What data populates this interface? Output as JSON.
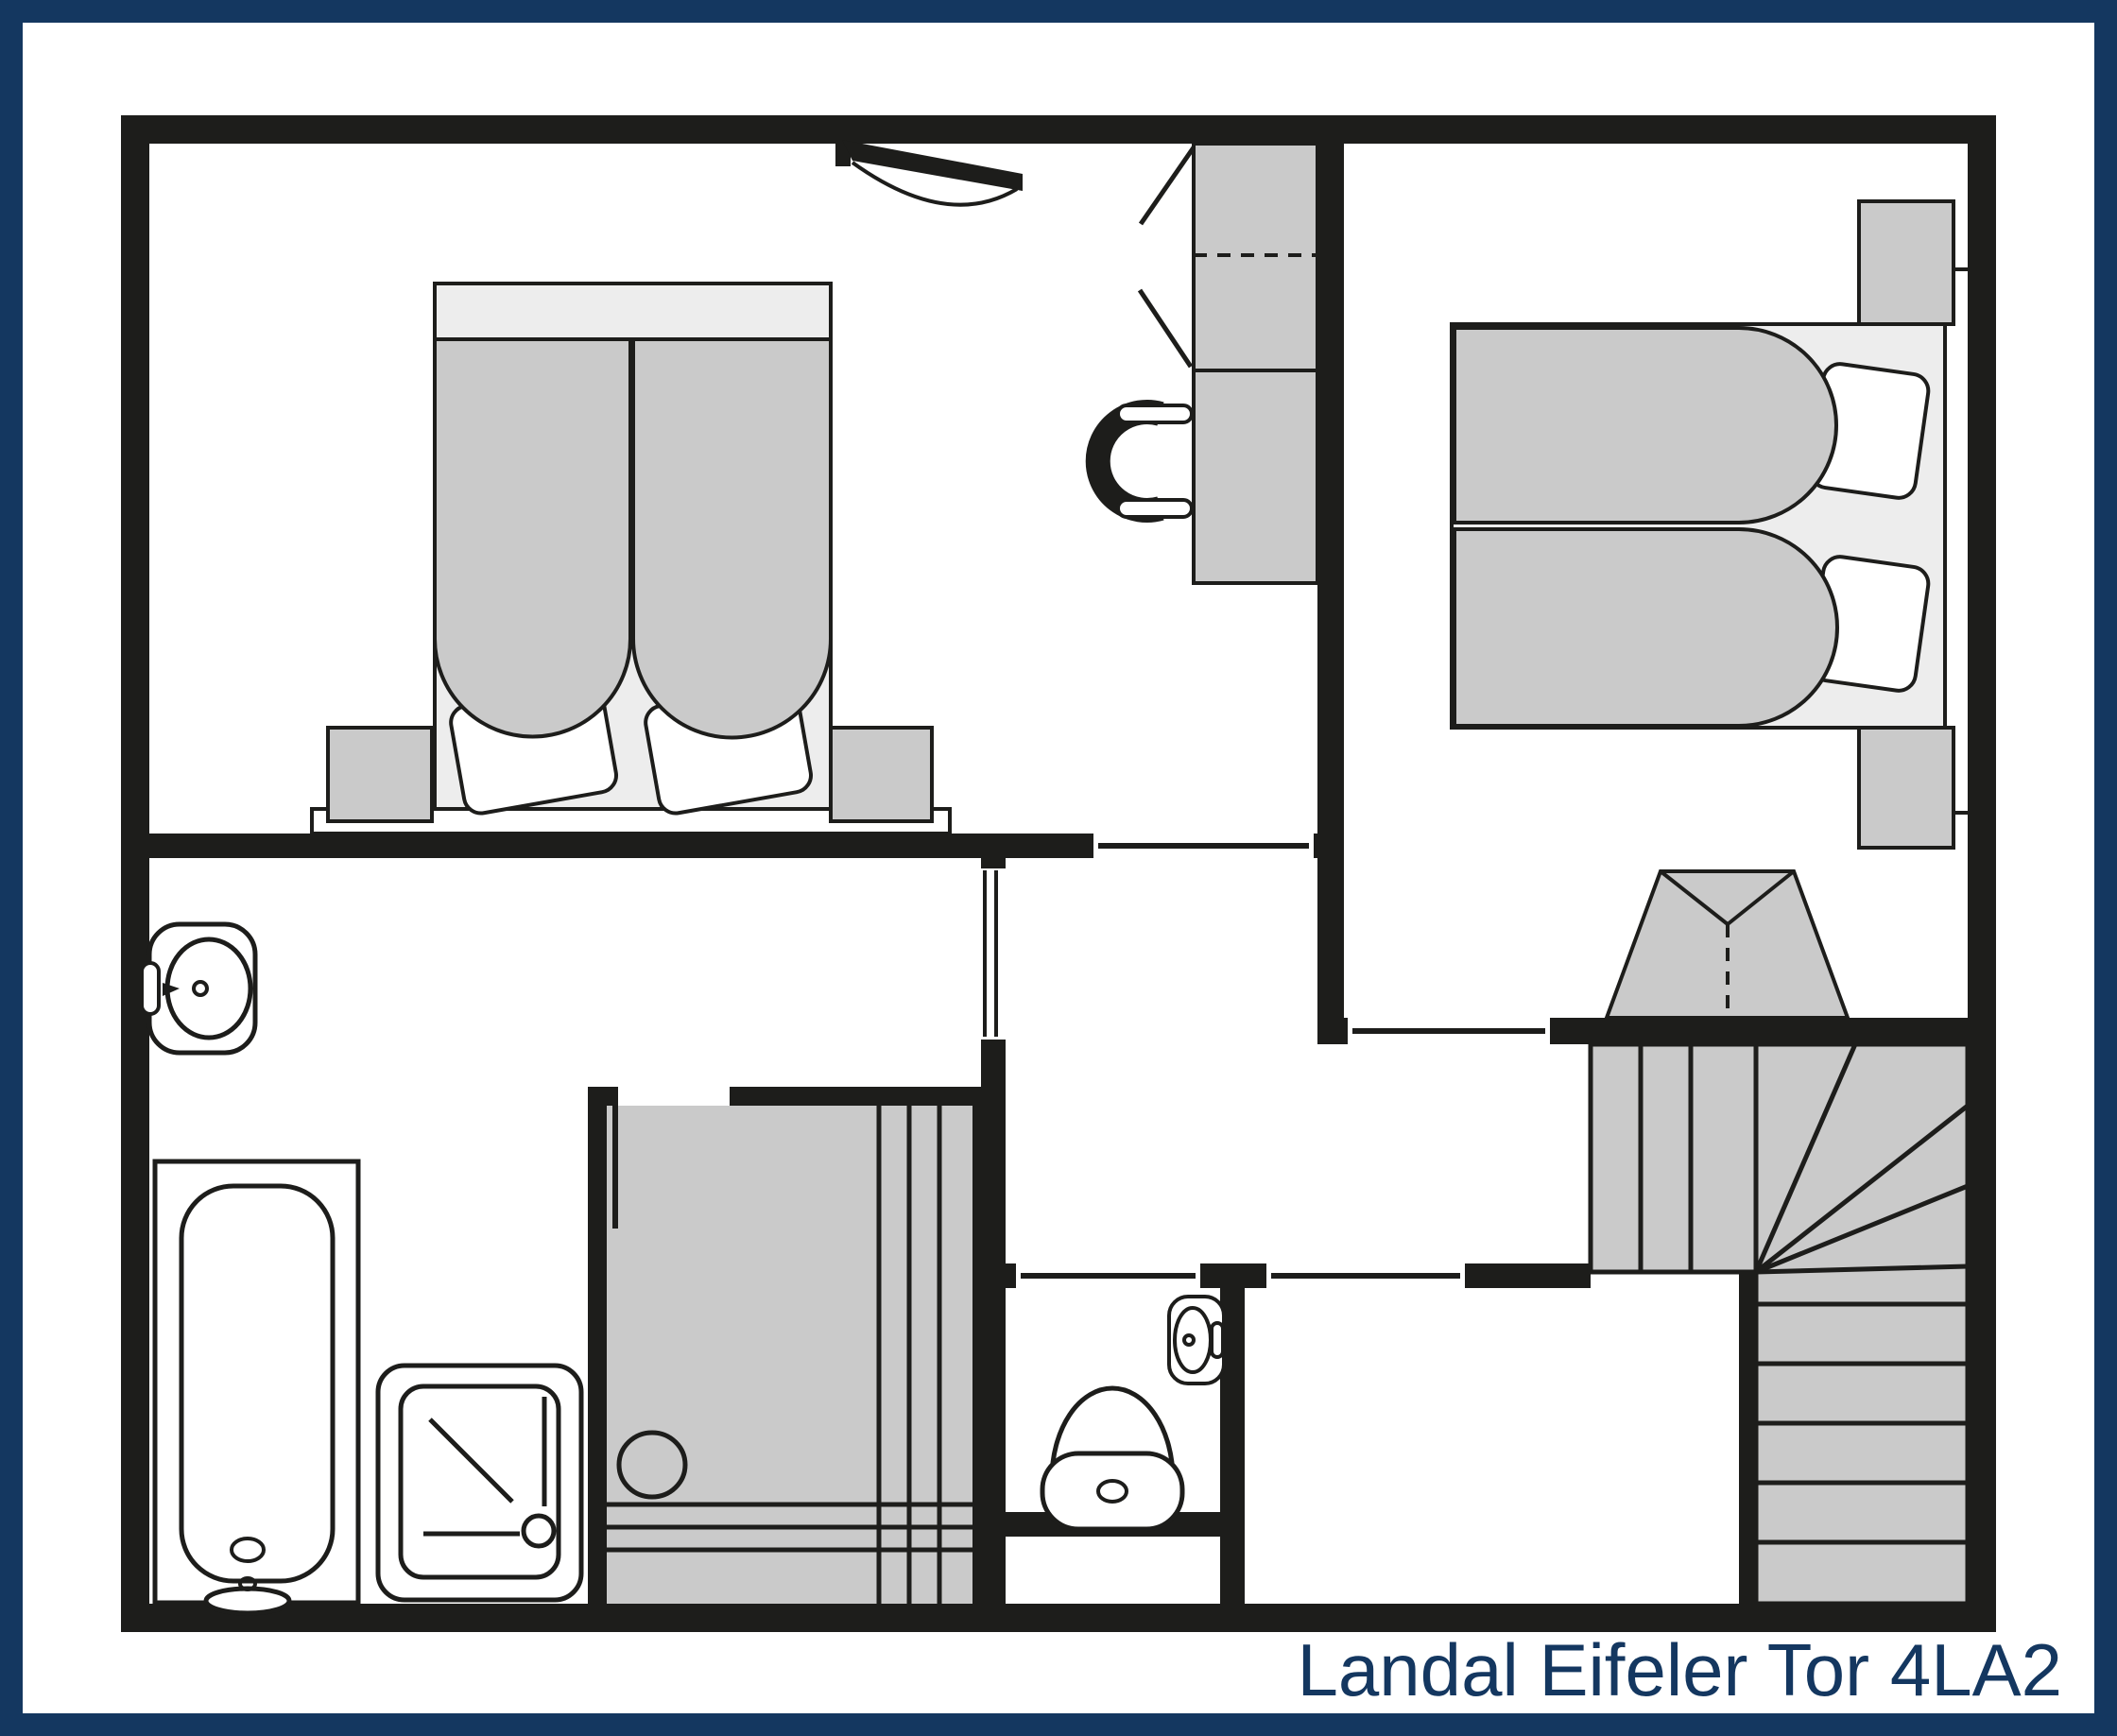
{
  "title": "Landal Eifeler Tor 4LA2",
  "colors": {
    "frame": "#143760",
    "wall": "#1d1d1b",
    "furniture_gray": "#cacaca",
    "bed_base_gray": "#ededed",
    "background": "#ffffff",
    "title_text": "#143760"
  },
  "icons": [
    "roof-window-icon",
    "double-bed-icon",
    "duvet-icon",
    "pillow-icon",
    "nightstand-icon",
    "wardrobe-icon",
    "desk-icon",
    "office-chair-icon",
    "washbasin-icon",
    "bathtub-icon",
    "shower-tray-icon",
    "sauna-icon",
    "sauna-heater-icon",
    "sauna-bench-icon",
    "toilet-icon",
    "corner-washbasin-icon",
    "winder-stairs-icon",
    "door-leaf-icon"
  ]
}
